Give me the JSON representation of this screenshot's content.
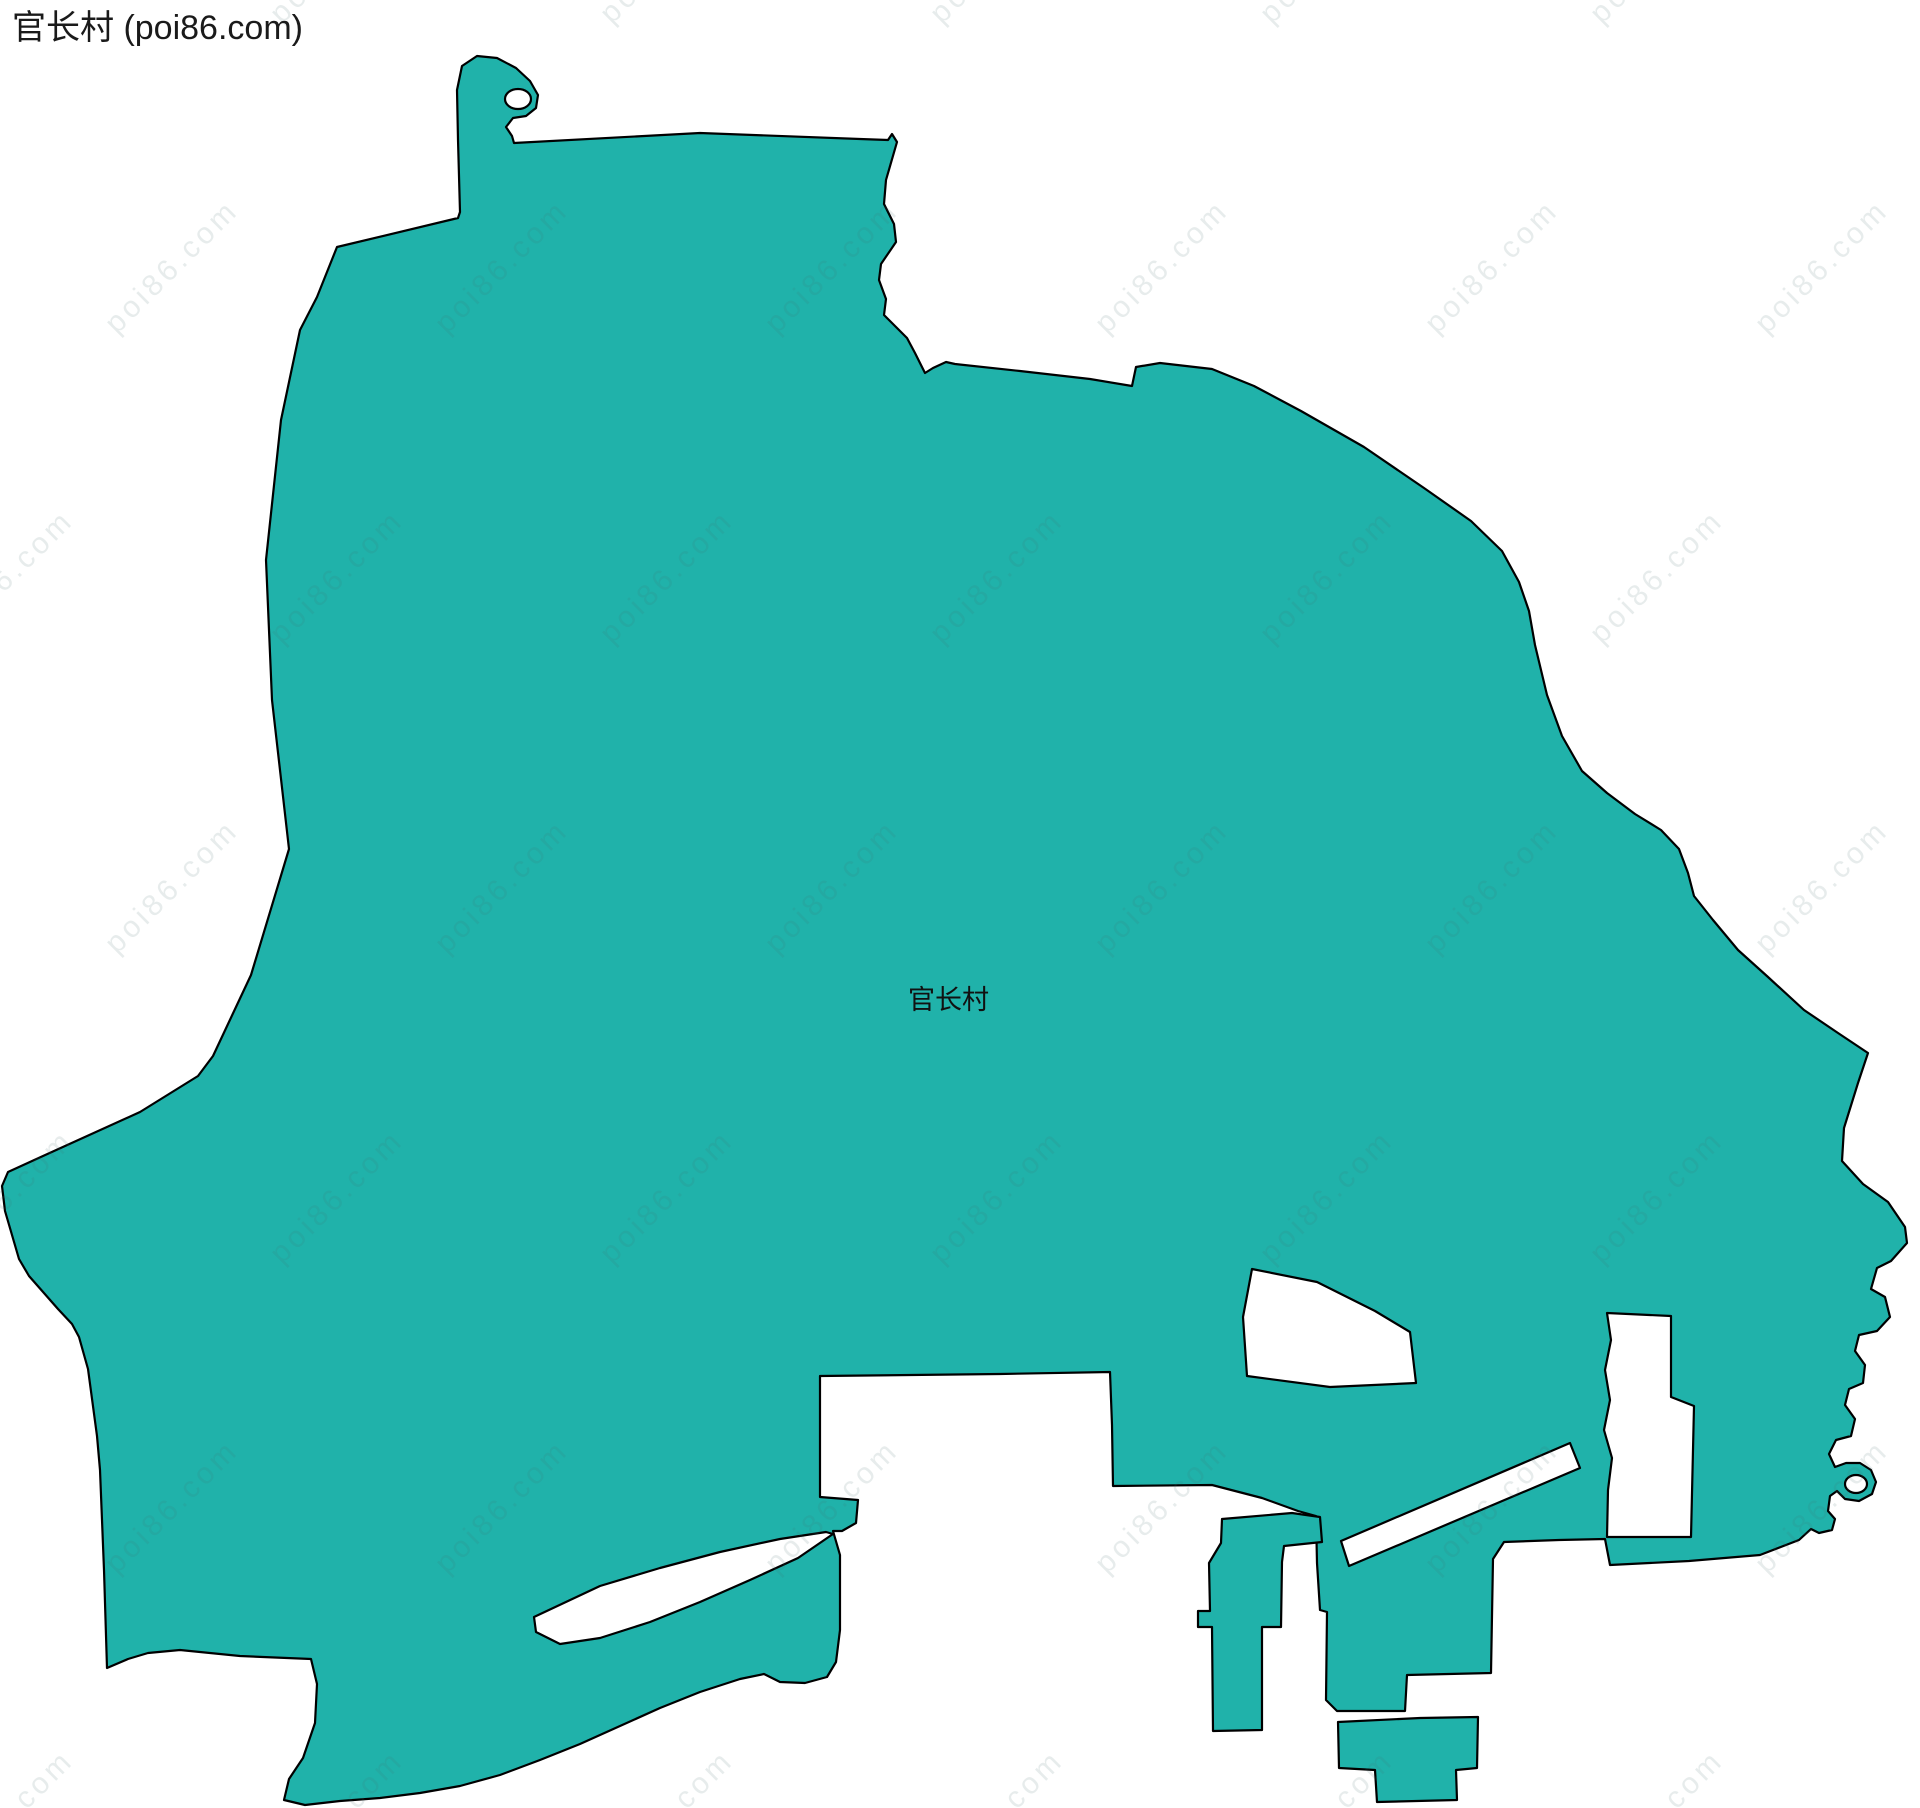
{
  "title": "官长村 (poi86.com)",
  "map": {
    "village_label": "官长村",
    "watermark": {
      "text": "poi86.com",
      "color": "rgba(70,105,105,0.13)",
      "x_gap": 330,
      "y_gap": 310,
      "row_offset": 165,
      "x_start": -80,
      "y_start": -60,
      "cols": 7,
      "rows": 7
    },
    "colors": {
      "region_fill": "#20B2AA",
      "outline": "#000000",
      "hole_fill": "#FFFFFF",
      "background": "#FFFFFF"
    },
    "shapes": {
      "main": [
        [
          460,
          212
        ],
        [
          458,
          140
        ],
        [
          457,
          90
        ],
        [
          462,
          66
        ],
        [
          477,
          56
        ],
        [
          497,
          58
        ],
        [
          516,
          68
        ],
        [
          530,
          81
        ],
        [
          538,
          95
        ],
        [
          536,
          108
        ],
        [
          526,
          116
        ],
        [
          513,
          118
        ],
        [
          506,
          127
        ],
        [
          512,
          136
        ],
        [
          514,
          143
        ],
        [
          700,
          133
        ],
        [
          860,
          139
        ],
        [
          888,
          140
        ],
        [
          892,
          134
        ],
        [
          897,
          142
        ],
        [
          886,
          180
        ],
        [
          884,
          204
        ],
        [
          894,
          224
        ],
        [
          896,
          242
        ],
        [
          881,
          264
        ],
        [
          879,
          280
        ],
        [
          886,
          299
        ],
        [
          884,
          315
        ],
        [
          899,
          330
        ],
        [
          907,
          338
        ],
        [
          915,
          353
        ],
        [
          925,
          373
        ],
        [
          933,
          368
        ],
        [
          946,
          362
        ],
        [
          955,
          364
        ],
        [
          1020,
          371
        ],
        [
          1090,
          379
        ],
        [
          1132,
          386
        ],
        [
          1136,
          367
        ],
        [
          1160,
          363
        ],
        [
          1212,
          369
        ],
        [
          1254,
          386
        ],
        [
          1301,
          411
        ],
        [
          1364,
          447
        ],
        [
          1424,
          488
        ],
        [
          1471,
          521
        ],
        [
          1502,
          551
        ],
        [
          1519,
          582
        ],
        [
          1529,
          611
        ],
        [
          1535,
          645
        ],
        [
          1547,
          695
        ],
        [
          1562,
          736
        ],
        [
          1582,
          771
        ],
        [
          1607,
          793
        ],
        [
          1635,
          814
        ],
        [
          1661,
          830
        ],
        [
          1679,
          849
        ],
        [
          1688,
          873
        ],
        [
          1694,
          896
        ],
        [
          1713,
          920
        ],
        [
          1738,
          950
        ],
        [
          1768,
          977
        ],
        [
          1804,
          1010
        ],
        [
          1838,
          1033
        ],
        [
          1868,
          1053
        ],
        [
          1858,
          1083
        ],
        [
          1844,
          1128
        ],
        [
          1842,
          1161
        ],
        [
          1863,
          1184
        ],
        [
          1888,
          1202
        ],
        [
          1905,
          1227
        ],
        [
          1907,
          1243
        ],
        [
          1891,
          1261
        ],
        [
          1877,
          1268
        ],
        [
          1871,
          1289
        ],
        [
          1885,
          1297
        ],
        [
          1890,
          1317
        ],
        [
          1877,
          1331
        ],
        [
          1859,
          1335
        ],
        [
          1855,
          1351
        ],
        [
          1865,
          1365
        ],
        [
          1863,
          1383
        ],
        [
          1849,
          1389
        ],
        [
          1845,
          1405
        ],
        [
          1855,
          1419
        ],
        [
          1851,
          1436
        ],
        [
          1836,
          1440
        ],
        [
          1829,
          1454
        ],
        [
          1835,
          1467
        ],
        [
          1846,
          1463
        ],
        [
          1860,
          1463
        ],
        [
          1871,
          1470
        ],
        [
          1876,
          1482
        ],
        [
          1872,
          1494
        ],
        [
          1859,
          1501
        ],
        [
          1845,
          1499
        ],
        [
          1837,
          1491
        ],
        [
          1830,
          1496
        ],
        [
          1828,
          1511
        ],
        [
          1835,
          1519
        ],
        [
          1832,
          1530
        ],
        [
          1819,
          1533
        ],
        [
          1811,
          1529
        ],
        [
          1799,
          1540
        ],
        [
          1760,
          1555
        ],
        [
          1689,
          1561
        ],
        [
          1610,
          1565
        ],
        [
          1605,
          1539
        ],
        [
          1559,
          1540
        ],
        [
          1504,
          1542
        ],
        [
          1493,
          1559
        ],
        [
          1491,
          1673
        ],
        [
          1407,
          1675
        ],
        [
          1405,
          1711
        ],
        [
          1337,
          1711
        ],
        [
          1326,
          1700
        ],
        [
          1327,
          1612
        ],
        [
          1320,
          1610
        ],
        [
          1317,
          1563
        ],
        [
          1316,
          1516
        ],
        [
          1298,
          1511
        ],
        [
          1262,
          1498
        ],
        [
          1212,
          1485
        ],
        [
          1113,
          1486
        ],
        [
          1112,
          1425
        ],
        [
          1110,
          1372
        ],
        [
          1000,
          1374
        ],
        [
          820,
          1376
        ],
        [
          820,
          1440
        ],
        [
          820,
          1497
        ],
        [
          858,
          1500
        ],
        [
          856,
          1523
        ],
        [
          842,
          1531
        ],
        [
          833,
          1531
        ],
        [
          840,
          1555
        ],
        [
          840,
          1630
        ],
        [
          836,
          1662
        ],
        [
          827,
          1677
        ],
        [
          805,
          1683
        ],
        [
          780,
          1682
        ],
        [
          764,
          1674
        ],
        [
          740,
          1679
        ],
        [
          700,
          1692
        ],
        [
          660,
          1708
        ],
        [
          620,
          1726
        ],
        [
          580,
          1744
        ],
        [
          540,
          1760
        ],
        [
          500,
          1775
        ],
        [
          460,
          1786
        ],
        [
          420,
          1793
        ],
        [
          380,
          1798
        ],
        [
          340,
          1801
        ],
        [
          305,
          1805
        ],
        [
          284,
          1800
        ],
        [
          289,
          1779
        ],
        [
          303,
          1758
        ],
        [
          315,
          1723
        ],
        [
          317,
          1684
        ],
        [
          311,
          1659
        ],
        [
          240,
          1656
        ],
        [
          180,
          1650
        ],
        [
          148,
          1653
        ],
        [
          128,
          1659
        ],
        [
          107,
          1668
        ],
        [
          104,
          1570
        ],
        [
          100,
          1470
        ],
        [
          97,
          1436
        ],
        [
          88,
          1369
        ],
        [
          79,
          1337
        ],
        [
          72,
          1324
        ],
        [
          58,
          1309
        ],
        [
          29,
          1276
        ],
        [
          19,
          1259
        ],
        [
          5,
          1211
        ],
        [
          2,
          1186
        ],
        [
          8,
          1172
        ],
        [
          43,
          1156
        ],
        [
          140,
          1112
        ],
        [
          198,
          1076
        ],
        [
          213,
          1056
        ],
        [
          251,
          975
        ],
        [
          289,
          849
        ],
        [
          272,
          700
        ],
        [
          266,
          560
        ],
        [
          281,
          420
        ],
        [
          300,
          330
        ],
        [
          317,
          297
        ],
        [
          337,
          247
        ],
        [
          458,
          218
        ]
      ],
      "holes": [
        {
          "type": "polygon",
          "name": "hole-northwest-hook-notch",
          "points": []
        },
        {
          "type": "ellipse",
          "name": "hole-hook-notch",
          "cx": 518,
          "cy": 99,
          "rx": 13,
          "ry": 10
        },
        {
          "type": "ellipse",
          "name": "hole-southeast-curl-notch",
          "cx": 1856,
          "cy": 1484,
          "rx": 11,
          "ry": 9
        },
        {
          "type": "polygon",
          "name": "hole-quad",
          "points": [
            [
              1252,
              1269
            ],
            [
              1317,
              1282
            ],
            [
              1375,
              1311
            ],
            [
              1410,
              1332
            ],
            [
              1416,
              1383
            ],
            [
              1330,
              1387
            ],
            [
              1247,
              1376
            ],
            [
              1243,
              1317
            ]
          ]
        },
        {
          "type": "polygon",
          "name": "hole-notch-rect",
          "points": [
            [
              1607,
              1313
            ],
            [
              1671,
              1316
            ],
            [
              1671,
              1397
            ],
            [
              1694,
              1406
            ],
            [
              1691,
              1537
            ],
            [
              1607,
              1537
            ],
            [
              1608,
              1490
            ],
            [
              1612,
              1458
            ],
            [
              1604,
              1430
            ],
            [
              1610,
              1400
            ],
            [
              1605,
              1370
            ],
            [
              1611,
              1340
            ]
          ]
        },
        {
          "type": "polygon",
          "name": "hole-channel",
          "points": [
            [
              1341,
              1541
            ],
            [
              1570,
              1443
            ],
            [
              1580,
              1468
            ],
            [
              1349,
              1566
            ]
          ]
        },
        {
          "type": "polygon",
          "name": "hole-sliver",
          "points": [
            [
              534,
              1617
            ],
            [
              600,
              1586
            ],
            [
              660,
              1568
            ],
            [
              720,
              1552
            ],
            [
              780,
              1539
            ],
            [
              826,
              1532
            ],
            [
              833,
              1534
            ],
            [
              798,
              1558
            ],
            [
              750,
              1580
            ],
            [
              700,
              1602
            ],
            [
              650,
              1622
            ],
            [
              600,
              1638
            ],
            [
              560,
              1644
            ],
            [
              536,
              1632
            ]
          ]
        }
      ],
      "islands": [
        {
          "type": "polygon",
          "name": "island-column",
          "points": [
            [
              1222,
              1519
            ],
            [
              1292,
              1513
            ],
            [
              1320,
              1517
            ],
            [
              1322,
              1542
            ],
            [
              1284,
              1546
            ],
            [
              1282,
              1562
            ],
            [
              1281,
              1627
            ],
            [
              1262,
              1627
            ],
            [
              1262,
              1730
            ],
            [
              1213,
              1731
            ],
            [
              1212,
              1627
            ],
            [
              1198,
              1627
            ],
            [
              1198,
              1611
            ],
            [
              1210,
              1611
            ],
            [
              1209,
              1563
            ],
            [
              1221,
              1543
            ]
          ]
        },
        {
          "type": "polygon",
          "name": "island-south",
          "points": [
            [
              1338,
              1722
            ],
            [
              1420,
              1718
            ],
            [
              1478,
              1717
            ],
            [
              1477,
              1768
            ],
            [
              1456,
              1770
            ],
            [
              1457,
              1800
            ],
            [
              1377,
              1802
            ],
            [
              1375,
              1770
            ],
            [
              1339,
              1768
            ]
          ]
        }
      ]
    }
  }
}
